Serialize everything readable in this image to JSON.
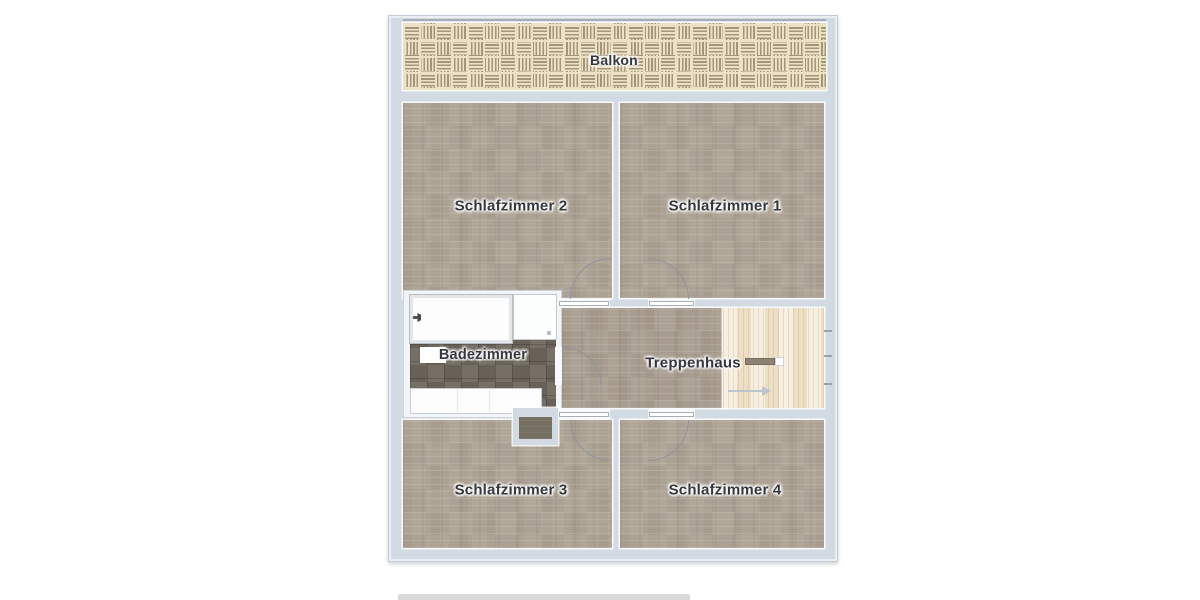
{
  "floorplan": {
    "rooms": [
      {
        "id": "balkon",
        "label": "Balkon"
      },
      {
        "id": "schlafzimmer-2",
        "label": "Schlafzimmer 2"
      },
      {
        "id": "schlafzimmer-1",
        "label": "Schlafzimmer 1"
      },
      {
        "id": "badezimmer",
        "label": "Badezimmer"
      },
      {
        "id": "treppenhaus",
        "label": "Treppenhaus"
      },
      {
        "id": "schlafzimmer-3",
        "label": "Schlafzimmer 3"
      },
      {
        "id": "schlafzimmer-4",
        "label": "Schlafzimmer 4"
      }
    ],
    "colors": {
      "exterior_wall": "#d2dae3",
      "bedroom_floor": "#aba091",
      "hallway_floor": "#a69b8c",
      "stairs_wood": "#f3e8d5",
      "balcony_weave_base": "#ece1c2",
      "balcony_weave_stripe": "#a3957c",
      "bathroom_tile": "#6e675d",
      "fixtures": "#ffffff",
      "label_text": "#34383e",
      "door_swing": "#8f959c"
    }
  }
}
